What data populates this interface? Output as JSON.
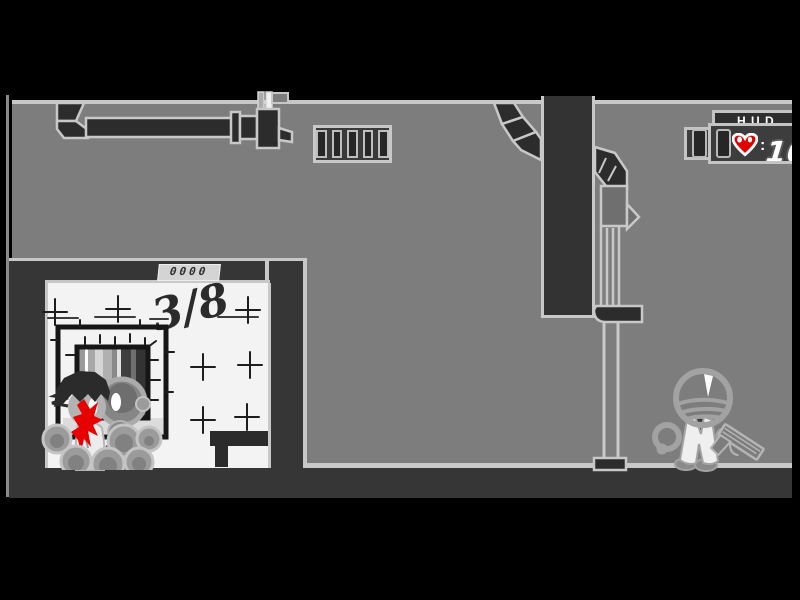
{
  "scene": {
    "name": "side-scrolling shooter level — gray warehouse interior"
  },
  "hud": {
    "title": "H.U.D.",
    "health_separator": ":",
    "health_value": "100",
    "heart_icon": "heart-icon",
    "ammo_icon": "ammo-slot-icon"
  },
  "room": {
    "wall_text": "3/8",
    "door_counter": "0000"
  },
  "icons": {
    "health": "heart-icon ♥",
    "ammo": "ammo-slot-icon ▯",
    "vent": "vent-grille-icon ▤"
  },
  "colors": {
    "wall": "#7d7d7d",
    "outline": "#c8c8c8",
    "dark": "#2c2c2c",
    "middark": "#363636",
    "column": "#333333",
    "room_white": "#f3f3f3",
    "blood": "#e60000",
    "heart": "#e00000",
    "hud_panel": "#3d3d3d",
    "hud_box": "#2e2e2e",
    "slot_dark": "#262626",
    "figure": "#a2a2a2",
    "bubble": "#9b9b9b",
    "ink": "#1d1d1d"
  }
}
